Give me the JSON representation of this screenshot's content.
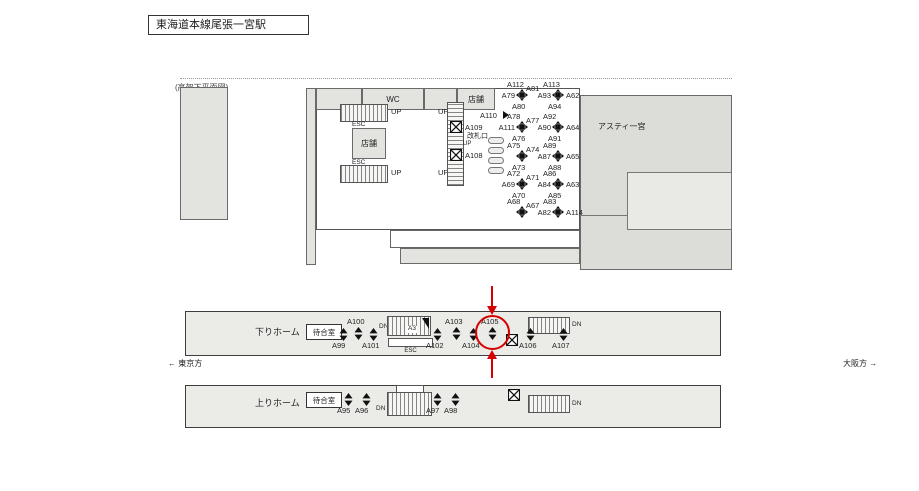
{
  "title": "東海道本線尾張一宮駅",
  "plan_note": "(高架下平面図)",
  "icons": {
    "pillar_marker": "four-face ad pillar (black square with 4 arrows)",
    "updown_marker": "two-face ad position (paired triangles)",
    "x_box": "boxed X marker",
    "right_arrow": "small right-pointing arrow"
  },
  "concourse": {
    "up": "UP",
    "esc": "ESC",
    "wc": "WC",
    "shop": "店舗",
    "gate": "改札口",
    "asty": "アスティ一宮",
    "a108": "A108",
    "a109": "A109",
    "a110": "A110",
    "pillars": [
      {
        "top": "A112",
        "tr": "A81",
        "left": "A79",
        "bottom": "A80"
      },
      {
        "top": "A113",
        "left": "A93",
        "right": "A62",
        "bottom": "A94"
      },
      {
        "top": "A78",
        "tr": "A77",
        "left": "A111",
        "bottom": "A76"
      },
      {
        "top": "A92",
        "left": "A90",
        "right": "A64",
        "bottom": "A91"
      },
      {
        "top": "A75",
        "tr": "A74",
        "bottom": "A73"
      },
      {
        "top": "A89",
        "left": "A87",
        "right": "A65",
        "bottom": "A88"
      },
      {
        "top": "A72",
        "tr": "A71",
        "left": "A69",
        "bottom": "A70"
      },
      {
        "top": "A86",
        "left": "A84",
        "right": "A63",
        "bottom": "A85"
      },
      {
        "top": "A68",
        "tr": "A67"
      },
      {
        "top": "A83",
        "left": "A82",
        "right": "A114"
      }
    ]
  },
  "down_platform": {
    "name": "下りホーム",
    "waiting_room": "待合室",
    "dn": "DN",
    "esc": "ESC",
    "stair_sign": "A3",
    "spots": {
      "a99": "A99",
      "a100": "A100",
      "a101": "A101",
      "a102": "A102",
      "a103": "A103",
      "a104": "A104",
      "a105": "A105",
      "a106": "A106",
      "a107": "A107"
    }
  },
  "up_platform": {
    "name": "上りホーム",
    "waiting_room": "待合室",
    "dn": "DN",
    "esc": "ESC",
    "spots": {
      "a95": "A95",
      "a96": "A96",
      "a97": "A97",
      "a98": "A98"
    }
  },
  "directions": {
    "tokyo": "← 東京方",
    "osaka": "大阪方 →"
  },
  "highlight": {
    "spot": "A105",
    "color": "#d60000"
  }
}
